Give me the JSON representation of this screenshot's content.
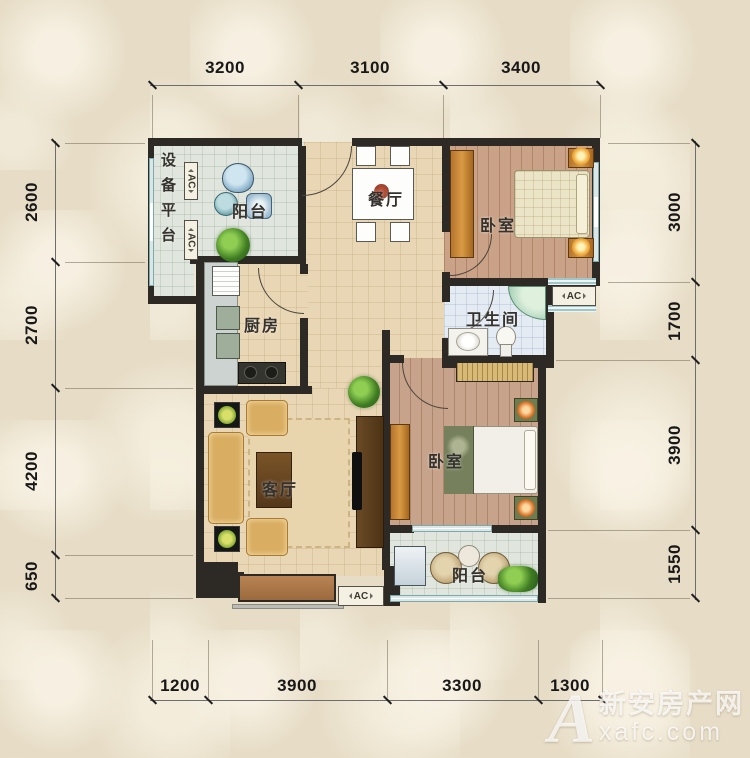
{
  "dimensions": {
    "top": [
      "3200",
      "3100",
      "3400"
    ],
    "bottom": [
      "1200",
      "3900",
      "3300",
      "1300"
    ],
    "left": [
      "2600",
      "2700",
      "4200",
      "650"
    ],
    "right": [
      "3000",
      "1700",
      "3900",
      "1550"
    ]
  },
  "rooms": {
    "equipment_platform": "设备平台",
    "balcony_top": "阳台",
    "dining": "餐厅",
    "bedroom_top": "卧室",
    "kitchen": "厨房",
    "bathroom": "卫生间",
    "living": "客厅",
    "bedroom_bottom": "卧室",
    "balcony_bottom": "阳台"
  },
  "ac_units": {
    "platform_top": "AC",
    "platform_bottom": "AC",
    "bathroom_side": "AC",
    "living_bottom": "AC"
  },
  "watermark": {
    "logo": "A",
    "site_name": "新安房产网",
    "site_url": "xafc.com"
  },
  "colors": {
    "wall": "#2d2a26",
    "floor_tile": "#e9d6b4",
    "floor_wood": "#c9a287",
    "floor_balcony": "#e0e6dd",
    "floor_bath": "#e4ebf3",
    "background": "#e7ddc7"
  }
}
